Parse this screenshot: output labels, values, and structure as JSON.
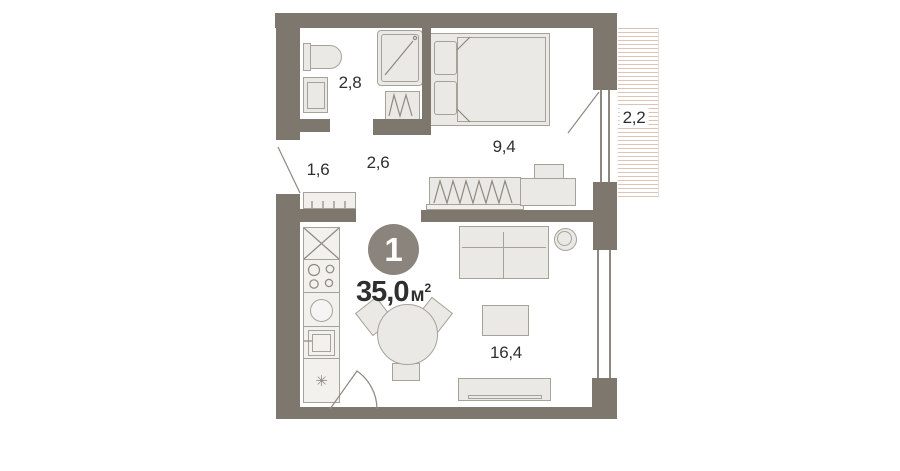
{
  "unit": {
    "rooms_badge": "1",
    "total_area_value": "35,0",
    "total_area_unit": "м",
    "total_area_sup": "2"
  },
  "areas": {
    "bathroom": "2,8",
    "hallway": "1,6",
    "corridor": "2,6",
    "bedroom": "9,4",
    "balcony": "2,2",
    "living_kitchen": "16,4"
  },
  "icons": {
    "fridge_snowflake": "✳"
  },
  "colors": {
    "background": "#ffffff",
    "wall": "#7e776e",
    "furniture_fill": "#ebe9e5",
    "furniture_stroke": "#a7a299",
    "counter_fill": "#f2f1ee",
    "line": "#8e887e",
    "balcony_hatch": "#dcc3b8",
    "badge_bg": "#8b847c",
    "badge_text": "#ffffff",
    "label_text": "#2f2f2f"
  }
}
